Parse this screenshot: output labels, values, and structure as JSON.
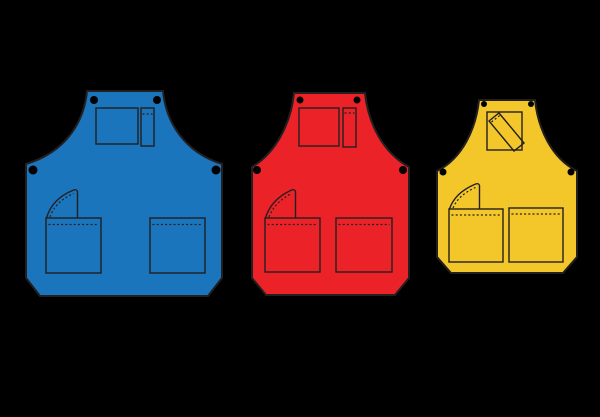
{
  "scene": {
    "background_color": "#000000",
    "outline_color": "#231F20",
    "grommet_color": "#000000"
  },
  "aprons": [
    {
      "label": "large-blue-apron",
      "color": "#1B75BC",
      "features": [
        "chest-pocket",
        "pen-pocket",
        "hammer-loop",
        "front-pocket-left",
        "front-pocket-right",
        "four-grommets",
        "dashed-stitching"
      ]
    },
    {
      "label": "medium-red-apron",
      "color": "#EB2228",
      "features": [
        "chest-pocket",
        "pen-pocket",
        "hammer-loop",
        "front-pocket-left",
        "front-pocket-right",
        "four-grommets",
        "dashed-stitching"
      ]
    },
    {
      "label": "small-yellow-apron",
      "color": "#F3C72A",
      "features": [
        "chest-pocket",
        "diagonal-pencil-in-chest-pocket",
        "hammer-loop",
        "front-pocket-left",
        "front-pocket-right",
        "four-grommets",
        "dashed-stitching"
      ]
    }
  ]
}
